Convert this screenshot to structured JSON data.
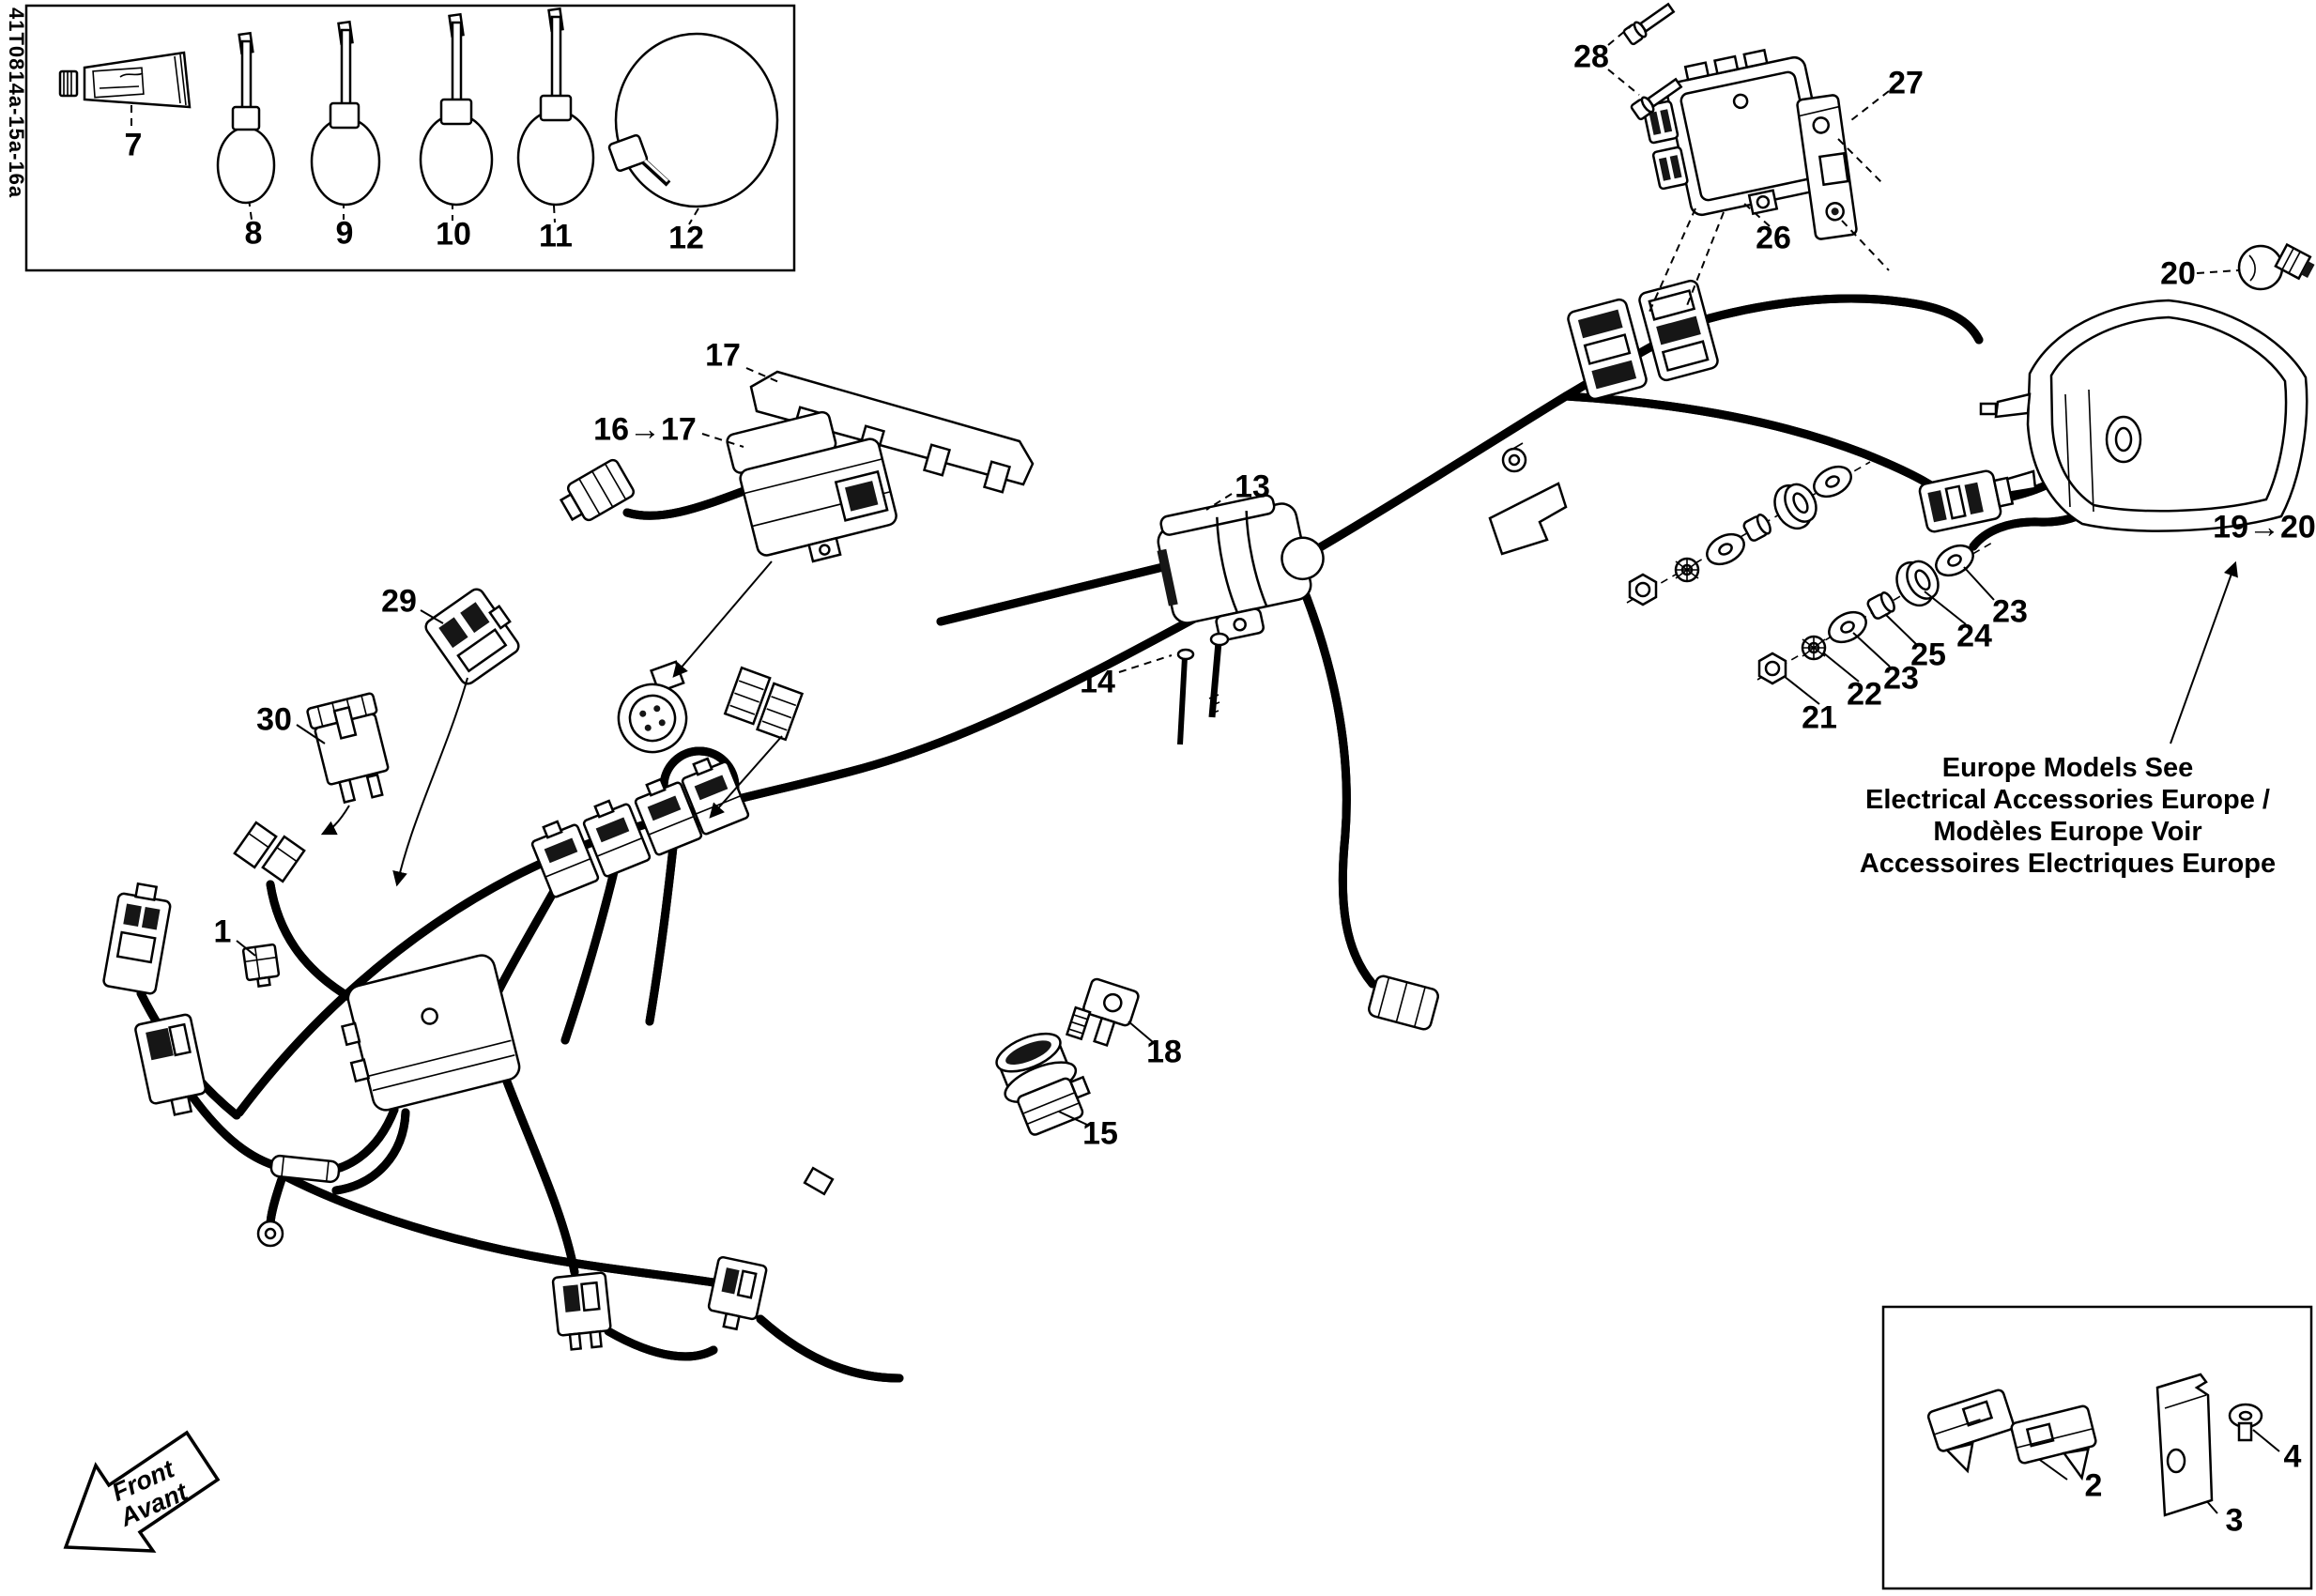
{
  "page": {
    "background": "#ffffff",
    "ink": "#000000"
  },
  "doc_code": "41T0814a-15a-16a",
  "front_arrow": {
    "line1": "Front",
    "line2": "Avant"
  },
  "europe_note": {
    "line1": "Europe Models See",
    "line2": "Electrical Accessories Europe /",
    "line3": "Modèles Europe Voir",
    "line4": "Accessoires Electriques Europe"
  },
  "callouts": {
    "c1": "1",
    "c2": "2",
    "c3": "3",
    "c4": "4",
    "c7": "7",
    "c8": "8",
    "c9": "9",
    "c10": "10",
    "c11": "11",
    "c12": "12",
    "c13": "13",
    "c14": "14",
    "c15": "15",
    "c16_17": "16→17",
    "c17": "17",
    "c18": "18",
    "c19_20": "19→20",
    "c20": "20",
    "c21": "21",
    "c22": "22",
    "c23_a": "23",
    "c23_b": "23",
    "c24": "24",
    "c25": "25",
    "c26": "26",
    "c27": "27",
    "c28": "28",
    "c29": "29",
    "c30": "30"
  }
}
